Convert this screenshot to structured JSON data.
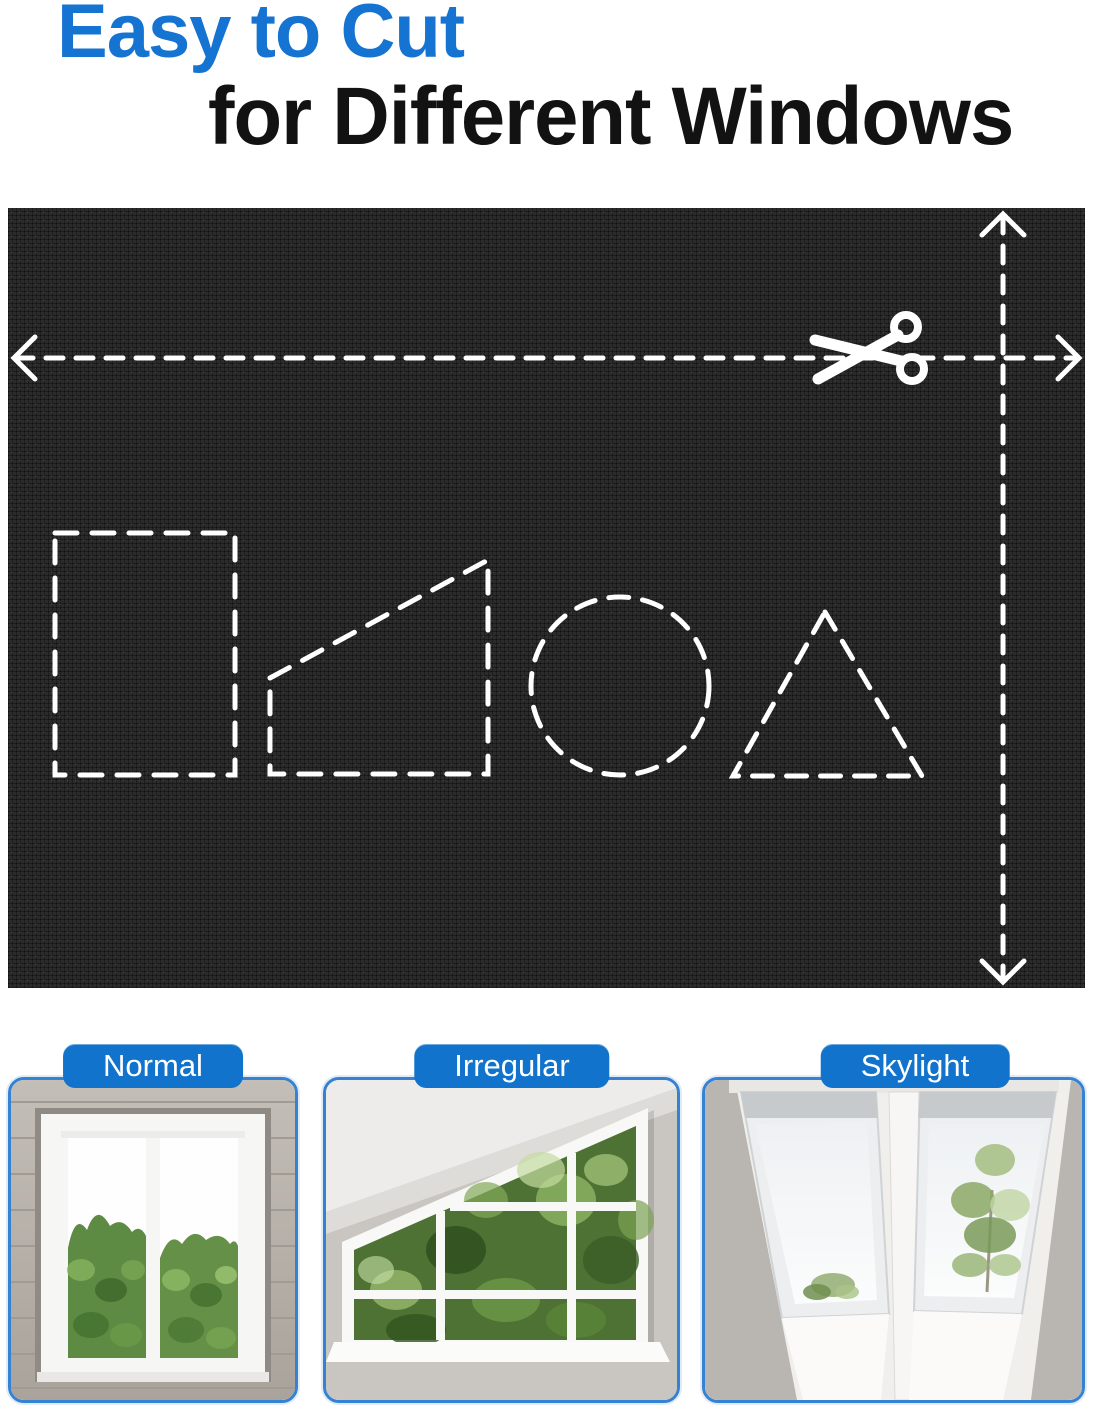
{
  "header": {
    "title_line1": "Easy to Cut",
    "title_line2": "for Different Windows",
    "title_color": "#1573d1",
    "subtitle_color": "#121212"
  },
  "fabric_panel": {
    "fabric_color": "#2b2b2b",
    "cut_line_color": "#ffffff",
    "icon": "scissors-icon",
    "guides": [
      "horizontal-width-cut-arrow",
      "vertical-height-cut-arrow"
    ],
    "cut_shapes": [
      "rectangle",
      "trapezoid",
      "circle",
      "triangle"
    ]
  },
  "window_types": {
    "label_bg_color": "#1173cb",
    "label_text_color": "#ffffff",
    "card_border_color": "#3582d2",
    "items": [
      {
        "label": "Normal",
        "photo": "normal-window-photo"
      },
      {
        "label": "Irregular",
        "photo": "irregular-window-photo"
      },
      {
        "label": "Skylight",
        "photo": "skylight-window-photo"
      }
    ]
  }
}
